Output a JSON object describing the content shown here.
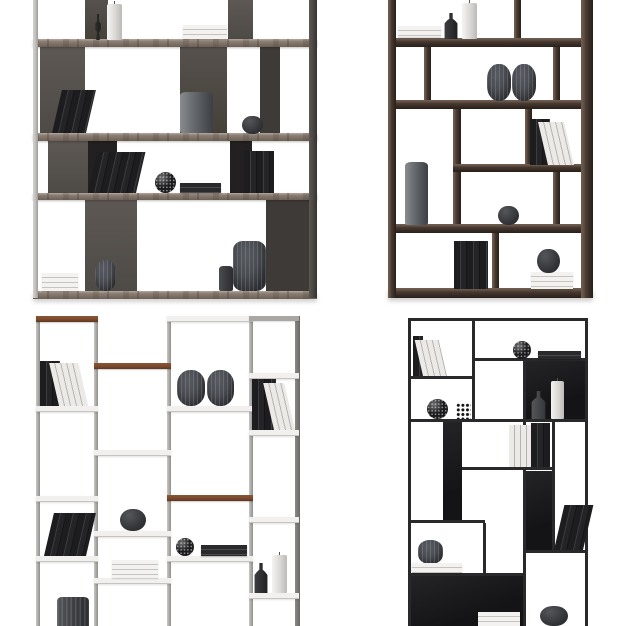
{
  "image_type": "3d furniture render collage, four bookcases on white background",
  "grid": {
    "rows": 2,
    "cols": 2
  },
  "palette": {
    "bg": "#ffffff",
    "wood-taupe": "#8b7e74",
    "wood-taupe-light": "#b5aa9e",
    "wood-taupe-dark": "#6d6156",
    "panel-gray": "#57524e",
    "panel-gray-dark": "#3e3a37",
    "panel-black": "#222020",
    "post-light": "#c7c5c2",
    "post-dark": "#4b4745",
    "walnut": "#463931",
    "walnut-light": "#6f5b4d",
    "walnut-dark": "#291f19",
    "metal-light": "#c9c7c4",
    "metal-dark": "#8b8885",
    "shelf-white": "#f1f0ee",
    "wood-accent": "#7b4a2e",
    "frame-black": "#29292b",
    "panel-jet": "#141416",
    "object-slate": "#4a4d53",
    "object-gray": "#6b6e72",
    "object-white": "#efeeec",
    "book-dark": "#1d1d1f",
    "book-white": "#eceae7"
  },
  "units": [
    {
      "position": "top-left",
      "style": "taupe wood shelves with staggered grey lacquer back panels, cropped at top",
      "shelves": 4,
      "items": [
        "black candlestick",
        "white pillar candle",
        "white book stack",
        "leaning dark books",
        "grey cylinder vase",
        "small black round vase",
        "leaning books",
        "speckled sphere ornament",
        "flat dark book stack",
        "standing dark books",
        "white book stack",
        "ribbed round vase",
        "large ribbed barrel vase",
        "small dark cylinder"
      ]
    },
    {
      "position": "top-right",
      "style": "dark walnut box frame with asymmetric compartments, cropped at top",
      "shelves": 5,
      "items": [
        "white book stack",
        "dark bottle vase",
        "white pillar candle",
        "two ribbed barrel vases",
        "leaning books",
        "tall grey cylinder vase",
        "small dark round vase",
        "standing dark books",
        "white book stack with dark round vase on top"
      ]
    },
    {
      "position": "bottom-left",
      "style": "light grey metal column shelving with white shelves and walnut accent shelves, cropped at bottom",
      "columns": 4,
      "items": [
        "standing and leaning books",
        "two ribbed barrel vases",
        "mixed books",
        "dark round vase",
        "speckled sphere ornament",
        "flat dark book stack",
        "leaning dark books",
        "white book stack",
        "dark bottle",
        "white pillar candle",
        "ribbed cylinder vase"
      ]
    },
    {
      "position": "bottom-right",
      "style": "thin black metal grid bookcase with black back panels, cropped at bottom",
      "items": [
        "mixed books",
        "speckled sphere ornament",
        "flat dark book stack",
        "dark bottle",
        "white pillar candle",
        "sphere ornament",
        "dotted cube ornament",
        "white standing books",
        "dark standing books",
        "leaning books",
        "ribbed dark vase",
        "white book stacks",
        "dark round vase"
      ]
    }
  ]
}
